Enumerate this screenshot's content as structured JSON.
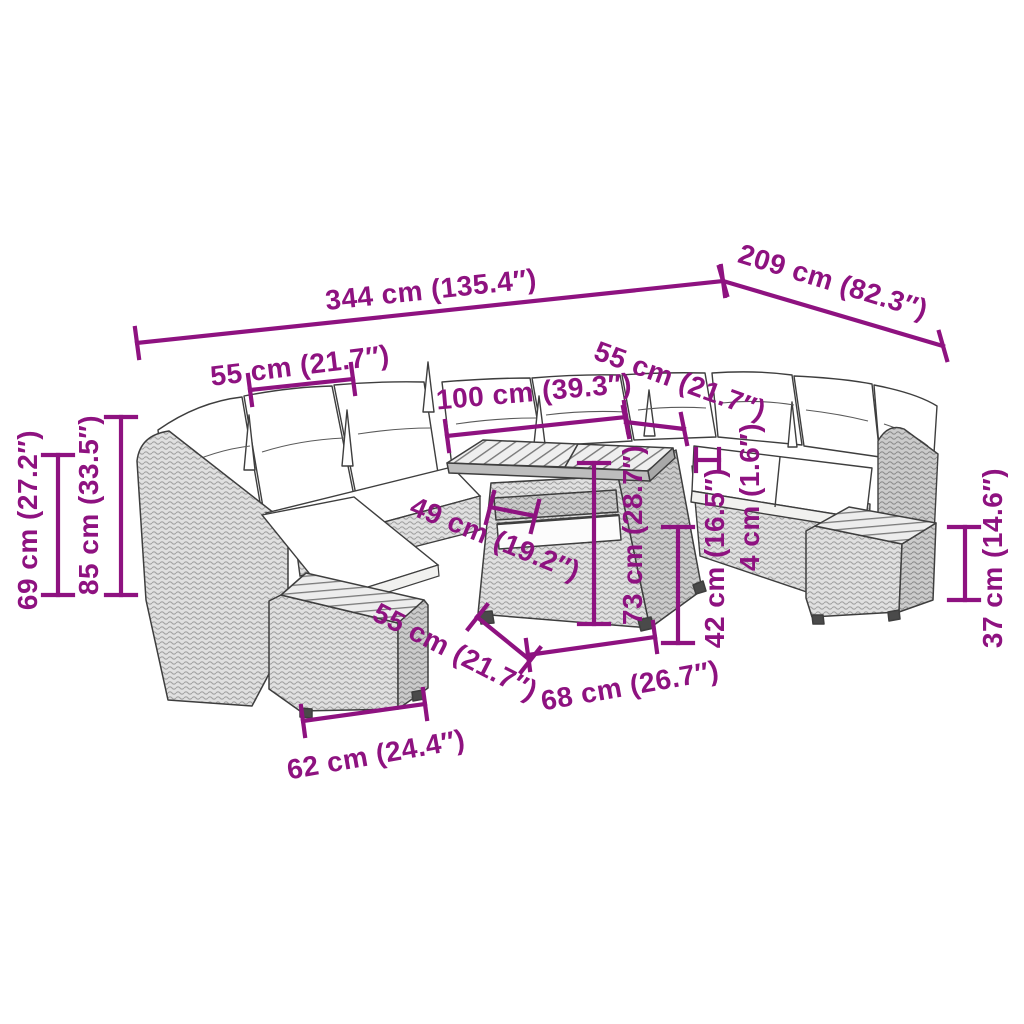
{
  "diagram": {
    "type": "product-dimension-diagram",
    "subject": "U-shaped poly rattan garden lounge set with cushions, cube table and two footstools",
    "colors": {
      "dimension_accent": "#8E1280",
      "line_art": "#3E3E3E",
      "background": "#FFFFFF"
    },
    "labels": {
      "total_width": "344 cm (135.4″)",
      "total_depth": "209 cm (82.3″)",
      "left_seat_width": "55 cm (21.7″)",
      "table_length": "100 cm (39.3″)",
      "right_seat_width": "55 cm (21.7″)",
      "left_height_outer": "69 cm (27.2″)",
      "left_height_total": "85 cm (33.5″)",
      "table_depth": "49 cm (19.2″)",
      "table_height": "73 cm (28.7″)",
      "cushion_thickness": "4 cm (1.6″)",
      "seat_height": "42 cm (16.5″)",
      "ottoman_depth": "55 cm (21.7″)",
      "table_base_width": "68 cm (26.7″)",
      "ottoman_width": "62 cm (24.4″)",
      "ottoman_height": "37 cm (14.6″)"
    }
  }
}
